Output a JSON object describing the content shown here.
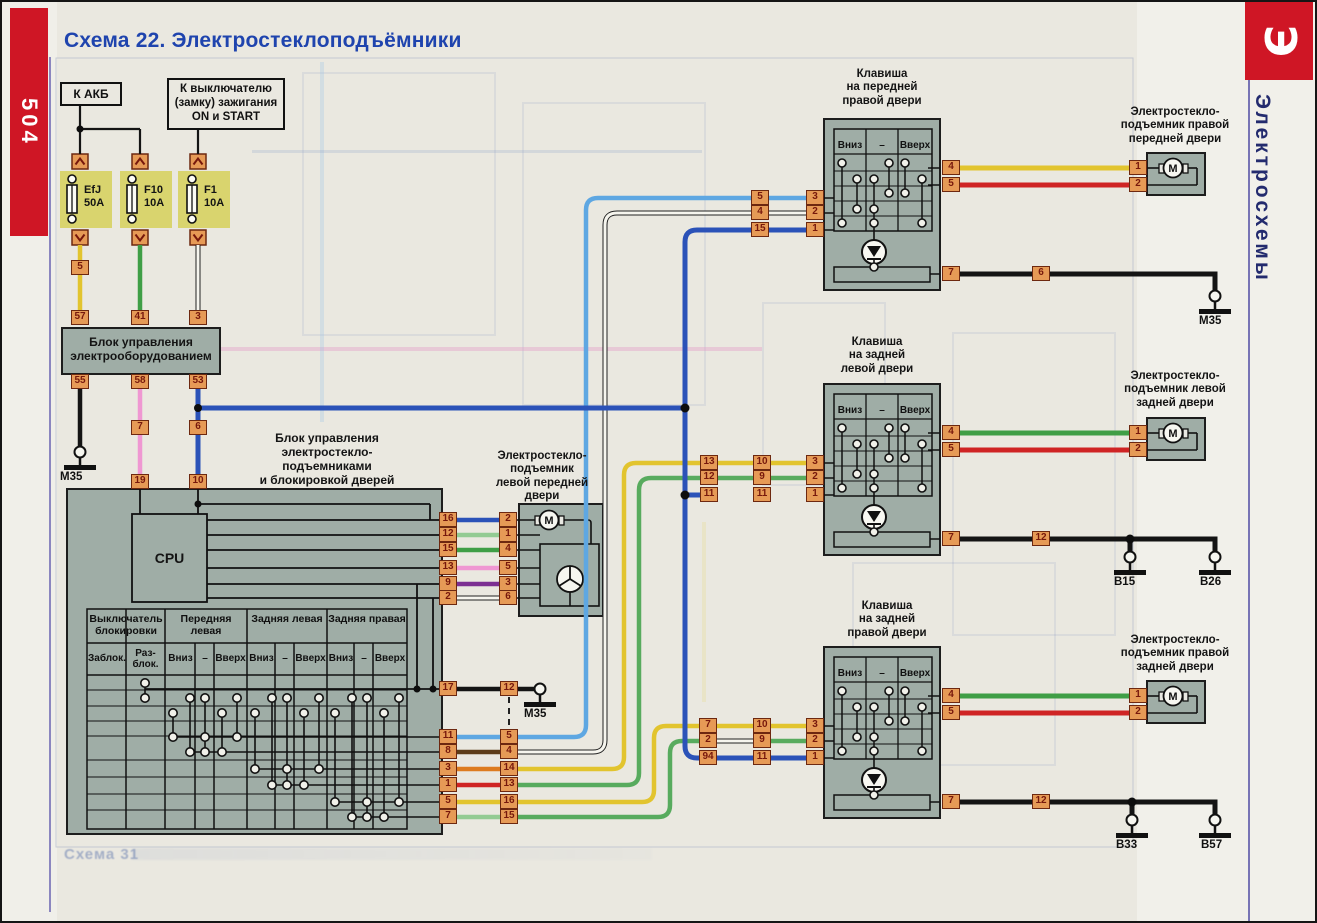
{
  "page": {
    "number": "504",
    "title": "Схема 22. Электростеклоподъёмники",
    "side_tab": "Э",
    "side_label": "Электросхемы",
    "ghost_caption": "Схема 31"
  },
  "palette": {
    "red": "#cf1625",
    "title-blue": "#1f44ae",
    "navy": "#232b6e",
    "panel": "#9fada6",
    "chip-bg": "#e69a56",
    "chip-border": "#6d2810",
    "chip-text": "#77180c",
    "fuse-bg": "#d9d46e",
    "paper": "#eae8e0",
    "wire-yellow": "#e2c42e",
    "wire-green": "#3f9e46",
    "wire-lgreen": "#93cb93",
    "wire-mgreen": "#58ab5e",
    "wire-dblue": "#2b52b8",
    "wire-lblue": "#5ea7e2",
    "wire-red": "#cf2424",
    "wire-pink": "#ef97d2",
    "wire-purple": "#7c2f92",
    "wire-orange": "#dd7b1f",
    "wire-brown": "#5d3c18",
    "wire-black": "#141414",
    "wire-white": "#f6f5ee"
  },
  "sources": {
    "battery": "К АКБ",
    "ignition_l1": "К выключателю",
    "ignition_l2": "(замку) зажигания",
    "ignition_l3": "ON и START"
  },
  "fuses": [
    {
      "name": "EfJ",
      "rating": "50A"
    },
    {
      "name": "F10",
      "rating": "10A"
    },
    {
      "name": "F1",
      "rating": "10A"
    }
  ],
  "ecu": {
    "l1": "Блок управления",
    "l2": "электрооборудованием"
  },
  "main_block": {
    "l1": "Блок управления",
    "l2": "электростекло-",
    "l3": "подъемниками",
    "l4": "и блокировкой дверей",
    "cpu": "CPU"
  },
  "lock_table": {
    "g_lock": "Выключатель блокировки",
    "g_fl": "Передняя левая",
    "g_rl": "Задняя левая",
    "g_rr": "Задняя правая",
    "lock": "Заблок.",
    "unlock_l1": "Раз-",
    "unlock_l2": "блок.",
    "down": "Вниз",
    "dash": "–",
    "up": "Вверх"
  },
  "switch_cols": {
    "down": "Вниз",
    "dash": "–",
    "up": "Вверх"
  },
  "units": {
    "fl_lifter": {
      "l1": "Электростекло-",
      "l2": "подъемник",
      "l3": "левой передней",
      "l4": "двери"
    },
    "fr_switch": {
      "l1": "Клавиша",
      "l2": "на передней",
      "l3": "правой двери"
    },
    "rl_switch": {
      "l1": "Клавиша",
      "l2": "на задней",
      "l3": "левой двери"
    },
    "rr_switch": {
      "l1": "Клавиша",
      "l2": "на задней",
      "l3": "правой двери"
    },
    "fr_lifter": {
      "l1": "Электростекло-",
      "l2": "подъемник правой",
      "l3": "передней двери"
    },
    "rl_lifter": {
      "l1": "Электростекло-",
      "l2": "подъемник левой",
      "l3": "задней двери"
    },
    "rr_lifter": {
      "l1": "Электростекло-",
      "l2": "подъемник правой",
      "l3": "задней двери"
    }
  },
  "motor_letter": "M",
  "pins": {
    "p5": "5",
    "ecu_top": [
      "57",
      "41",
      "3"
    ],
    "ecu_bot": [
      "55",
      "58",
      "53"
    ],
    "p7": "7",
    "p6": "6",
    "p19": "19",
    "p10": "10",
    "cpu_out": [
      "16",
      "12",
      "15",
      "13",
      "9",
      "2"
    ],
    "fl_in": [
      "2",
      "1",
      "4",
      "5",
      "3",
      "6"
    ],
    "blk_right": [
      "17",
      "11",
      "8",
      "3",
      "1",
      "5",
      "7"
    ],
    "blk_pair": [
      "12",
      "5",
      "4",
      "14",
      "13",
      "16",
      "15"
    ],
    "fr_a": [
      "5",
      "4",
      "15"
    ],
    "fr_b": [
      "3",
      "2",
      "1"
    ],
    "fr_r": [
      "4",
      "5"
    ],
    "fr_gnd": "7",
    "fr_inline": "6",
    "fr_m": [
      "1",
      "2"
    ],
    "rl_a": [
      "13",
      "12",
      "11"
    ],
    "rl_b": [
      "10",
      "9",
      "11"
    ],
    "rl_c": [
      "3",
      "2",
      "1"
    ],
    "rl_r": [
      "4",
      "5"
    ],
    "rl_gnd": "7",
    "rl_inline": "12",
    "rl_m": [
      "1",
      "2"
    ],
    "rr_a": [
      "7",
      "2",
      "94"
    ],
    "rr_b": [
      "10",
      "9",
      "11"
    ],
    "rr_c": [
      "3",
      "2",
      "1"
    ],
    "rr_r": [
      "4",
      "5"
    ],
    "rr_gnd": "7",
    "rr_inline": "12",
    "rr_m": [
      "1",
      "2"
    ]
  },
  "grounds": {
    "m35_left": "М35",
    "m35_table": "М35",
    "m35_fr": "М35",
    "b15": "В15",
    "b26": "В26",
    "b33": "В33",
    "b57": "В57"
  }
}
